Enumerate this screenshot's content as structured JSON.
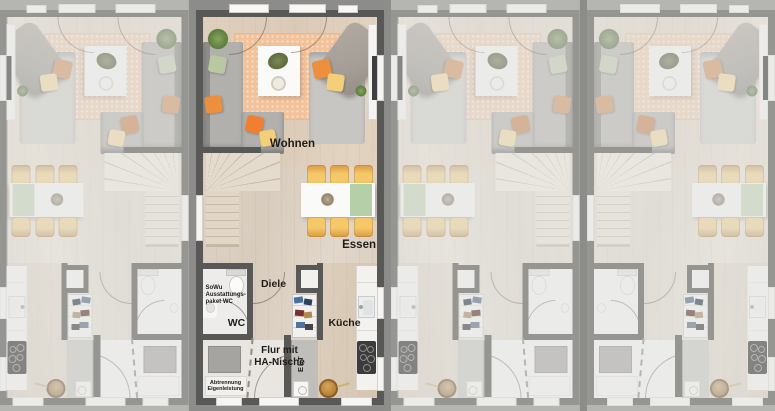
{
  "scene": {
    "type": "architectural-floor-plan-render",
    "description": "Top view of four townhouse ground-floor plans in a row; second unit highlighted with room labels, other units dimmed",
    "unit_count": 4
  },
  "labels": {
    "wohnen": "Wohnen",
    "essen": "Essen",
    "diele": "Diele",
    "wc": "WC",
    "kueche": "Küche",
    "flur_line1": "Flur mit",
    "flur_line2": "HA-Nische",
    "elt": "ELT",
    "sowu_line1": "SoWu",
    "sowu_line2": "Ausstattungs-",
    "sowu_line3": "paket WC",
    "abtrennung_line1": "Abtrennung",
    "abtrennung_line2": "Eigenleistung"
  },
  "units": [
    {
      "id": "unit-1",
      "mirrored": true,
      "highlighted": false
    },
    {
      "id": "unit-2",
      "mirrored": false,
      "highlighted": true
    },
    {
      "id": "unit-3",
      "mirrored": true,
      "highlighted": false
    },
    {
      "id": "unit-4",
      "mirrored": false,
      "highlighted": false
    }
  ],
  "colors": {
    "gap": "#8c8c8a",
    "wall": "#585856",
    "rug": "#f2c29b",
    "sofa": "#b2b0ad",
    "sofaLight": "#c8c6c3",
    "blanket": "#a59e96",
    "table": "#fafaf8",
    "runnerGreen": "#b5cfa8",
    "chairYellow": "#f5c869",
    "chairEdge": "#d89a44",
    "pillowGreen": "#b9c7a2",
    "pillowOrange": "#ee8f3e",
    "pillowOrangeBright": "#f08030",
    "pillowYellow": "#f3cf7a",
    "plantGreen": "#7b9a55",
    "counter": "#f3f2ef",
    "cooktop": "#3b3b3b",
    "shaft": "#c0beba",
    "stairs": "#e4dbcc",
    "floorFlur": "#e9e6e2",
    "floorWC": "#edecea",
    "basket": "#b27a33",
    "tv": "#3f3f3f",
    "label": "#1f1d1a"
  }
}
